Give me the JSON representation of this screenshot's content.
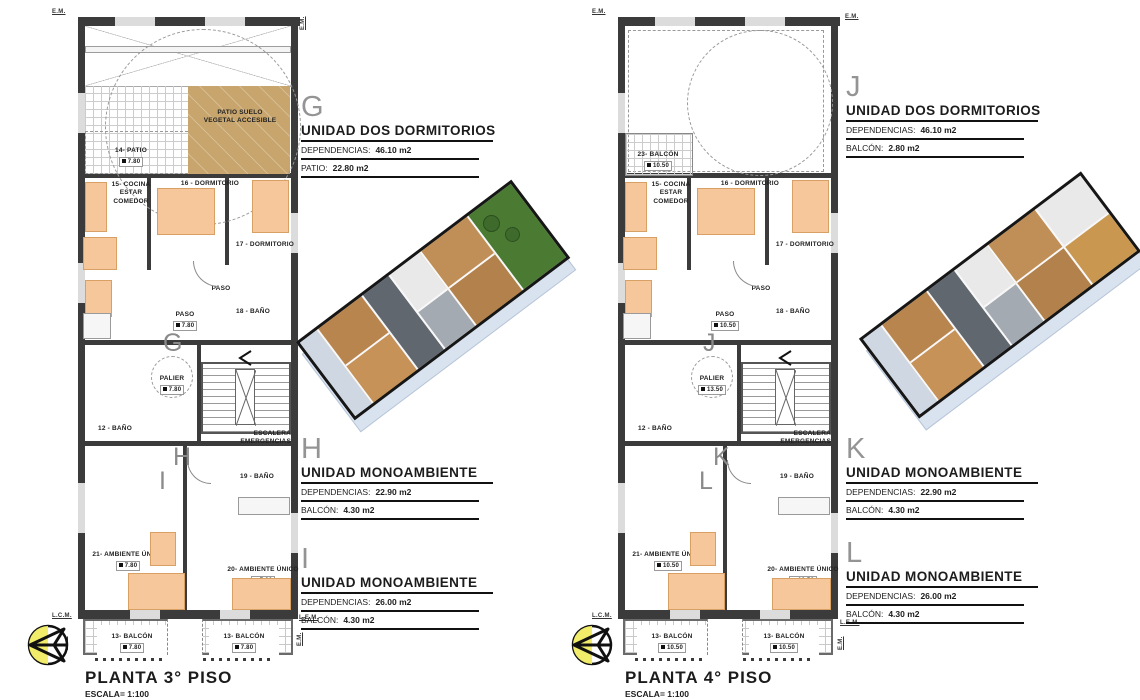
{
  "colors": {
    "wall": "#3b3b3b",
    "furniture": "#f5c79a",
    "patio_fill": "#c7a56d",
    "unit_letter_gray": "#949494",
    "render_wood": "#b9854e",
    "render_green": "#4b7a33",
    "compass_yellow": "#f1ec6a"
  },
  "lp": {
    "title": "PLANTA 3° PISO",
    "scale": "ESCALA= 1:100",
    "letters": {
      "a": "G",
      "b": "H",
      "c": "I"
    },
    "units": [
      {
        "letter": "G",
        "name": "UNIDAD DOS DORMITORIOS",
        "r1l": "DEPENDENCIAS:",
        "r1v": "46.10 m2",
        "r2l": "PATIO:",
        "r2v": "22.80 m2"
      },
      {
        "letter": "H",
        "name": "UNIDAD MONOAMBIENTE",
        "r1l": "DEPENDENCIAS:",
        "r1v": "22.90 m2",
        "r2l": "BALCÓN:",
        "r2v": "4.30 m2"
      },
      {
        "letter": "I",
        "name": "UNIDAD MONOAMBIENTE",
        "r1l": "DEPENDENCIAS:",
        "r1v": "26.00 m2",
        "r2l": "BALCÓN:",
        "r2v": "4.30 m2"
      }
    ],
    "rooms": {
      "patio_surface": "PATIO SUELO\nVEGETAL ACCESIBLE",
      "patio14": "14- PATIO",
      "patio14_v": "7.80",
      "kitchen15": "15- COCINA\nESTAR\nCOMEDOR",
      "dorm16": "16 - DORMITORIO",
      "dorm17": "17 - DORMITORIO",
      "paso_a": "PASO",
      "paso_b": "PASO",
      "paso_b_v": "7.80",
      "bath18": "18 - BAÑO",
      "palier": "PALIER",
      "palier_v": "7.80",
      "bath12": "12 - BAÑO",
      "escalera": "ESCALERA\nEMERGENCIAS",
      "bath19": "19 - BAÑO",
      "amb21": "21- AMBIENTE ÚNICO",
      "amb21_v": "7.80",
      "amb20": "20- AMBIENTE ÚNICO",
      "amb20_v": "7.80",
      "balc13a": "13- BALCÓN",
      "balc13a_v": "7.80",
      "balc13b": "13- BALCÓN",
      "balc13b_v": "7.80"
    },
    "edges": {
      "tl": "E.M.",
      "tr": "E.M.",
      "bl": "L.C.M.",
      "br": "L.E.M.",
      "side_l": "E.M.",
      "side_r": "E.M."
    }
  },
  "rp": {
    "title": "PLANTA 4° PISO",
    "scale": "ESCALA= 1:100",
    "letters": {
      "a": "J",
      "b": "K",
      "c": "L"
    },
    "units": [
      {
        "letter": "J",
        "name": "UNIDAD DOS DORMITORIOS",
        "r1l": "DEPENDENCIAS:",
        "r1v": "46.10 m2",
        "r2l": "BALCÓN:",
        "r2v": "2.80 m2"
      },
      {
        "letter": "K",
        "name": "UNIDAD MONOAMBIENTE",
        "r1l": "DEPENDENCIAS:",
        "r1v": "22.90 m2",
        "r2l": "BALCÓN:",
        "r2v": "4.30 m2"
      },
      {
        "letter": "L",
        "name": "UNIDAD MONOAMBIENTE",
        "r1l": "DEPENDENCIAS:",
        "r1v": "26.00 m2",
        "r2l": "BALCÓN:",
        "r2v": "4.30 m2"
      }
    ],
    "rooms": {
      "balc23": "23- BALCÓN",
      "balc23_v": "10.50",
      "kitchen15": "15- COCINA\nESTAR\nCOMEDOR",
      "dorm16": "16 - DORMITORIO",
      "dorm17": "17 - DORMITORIO",
      "paso_a": "PASO",
      "paso_b": "PASO",
      "paso_b_v": "10.50",
      "bath18": "18 - BAÑO",
      "palier": "PALIER",
      "palier_v": "13.50",
      "bath12": "12 - BAÑO",
      "escalera": "ESCALERA\nEMERGENCIAS",
      "bath19": "19 - BAÑO",
      "amb21": "21- AMBIENTE ÚNICO",
      "amb21_v": "10.50",
      "amb20": "20- AMBIENTE ÚNICO",
      "amb20_v": "10.50",
      "balc13a": "13- BALCÓN",
      "balc13a_v": "10.50",
      "balc13b": "13- BALCÓN",
      "balc13b_v": "10.50"
    },
    "edges": {
      "tl": "E.M.",
      "tr": "E.M.",
      "bl": "L.C.M.",
      "br": "L.E.M.",
      "side_l": "E.M.",
      "side_r": "E.M."
    }
  }
}
